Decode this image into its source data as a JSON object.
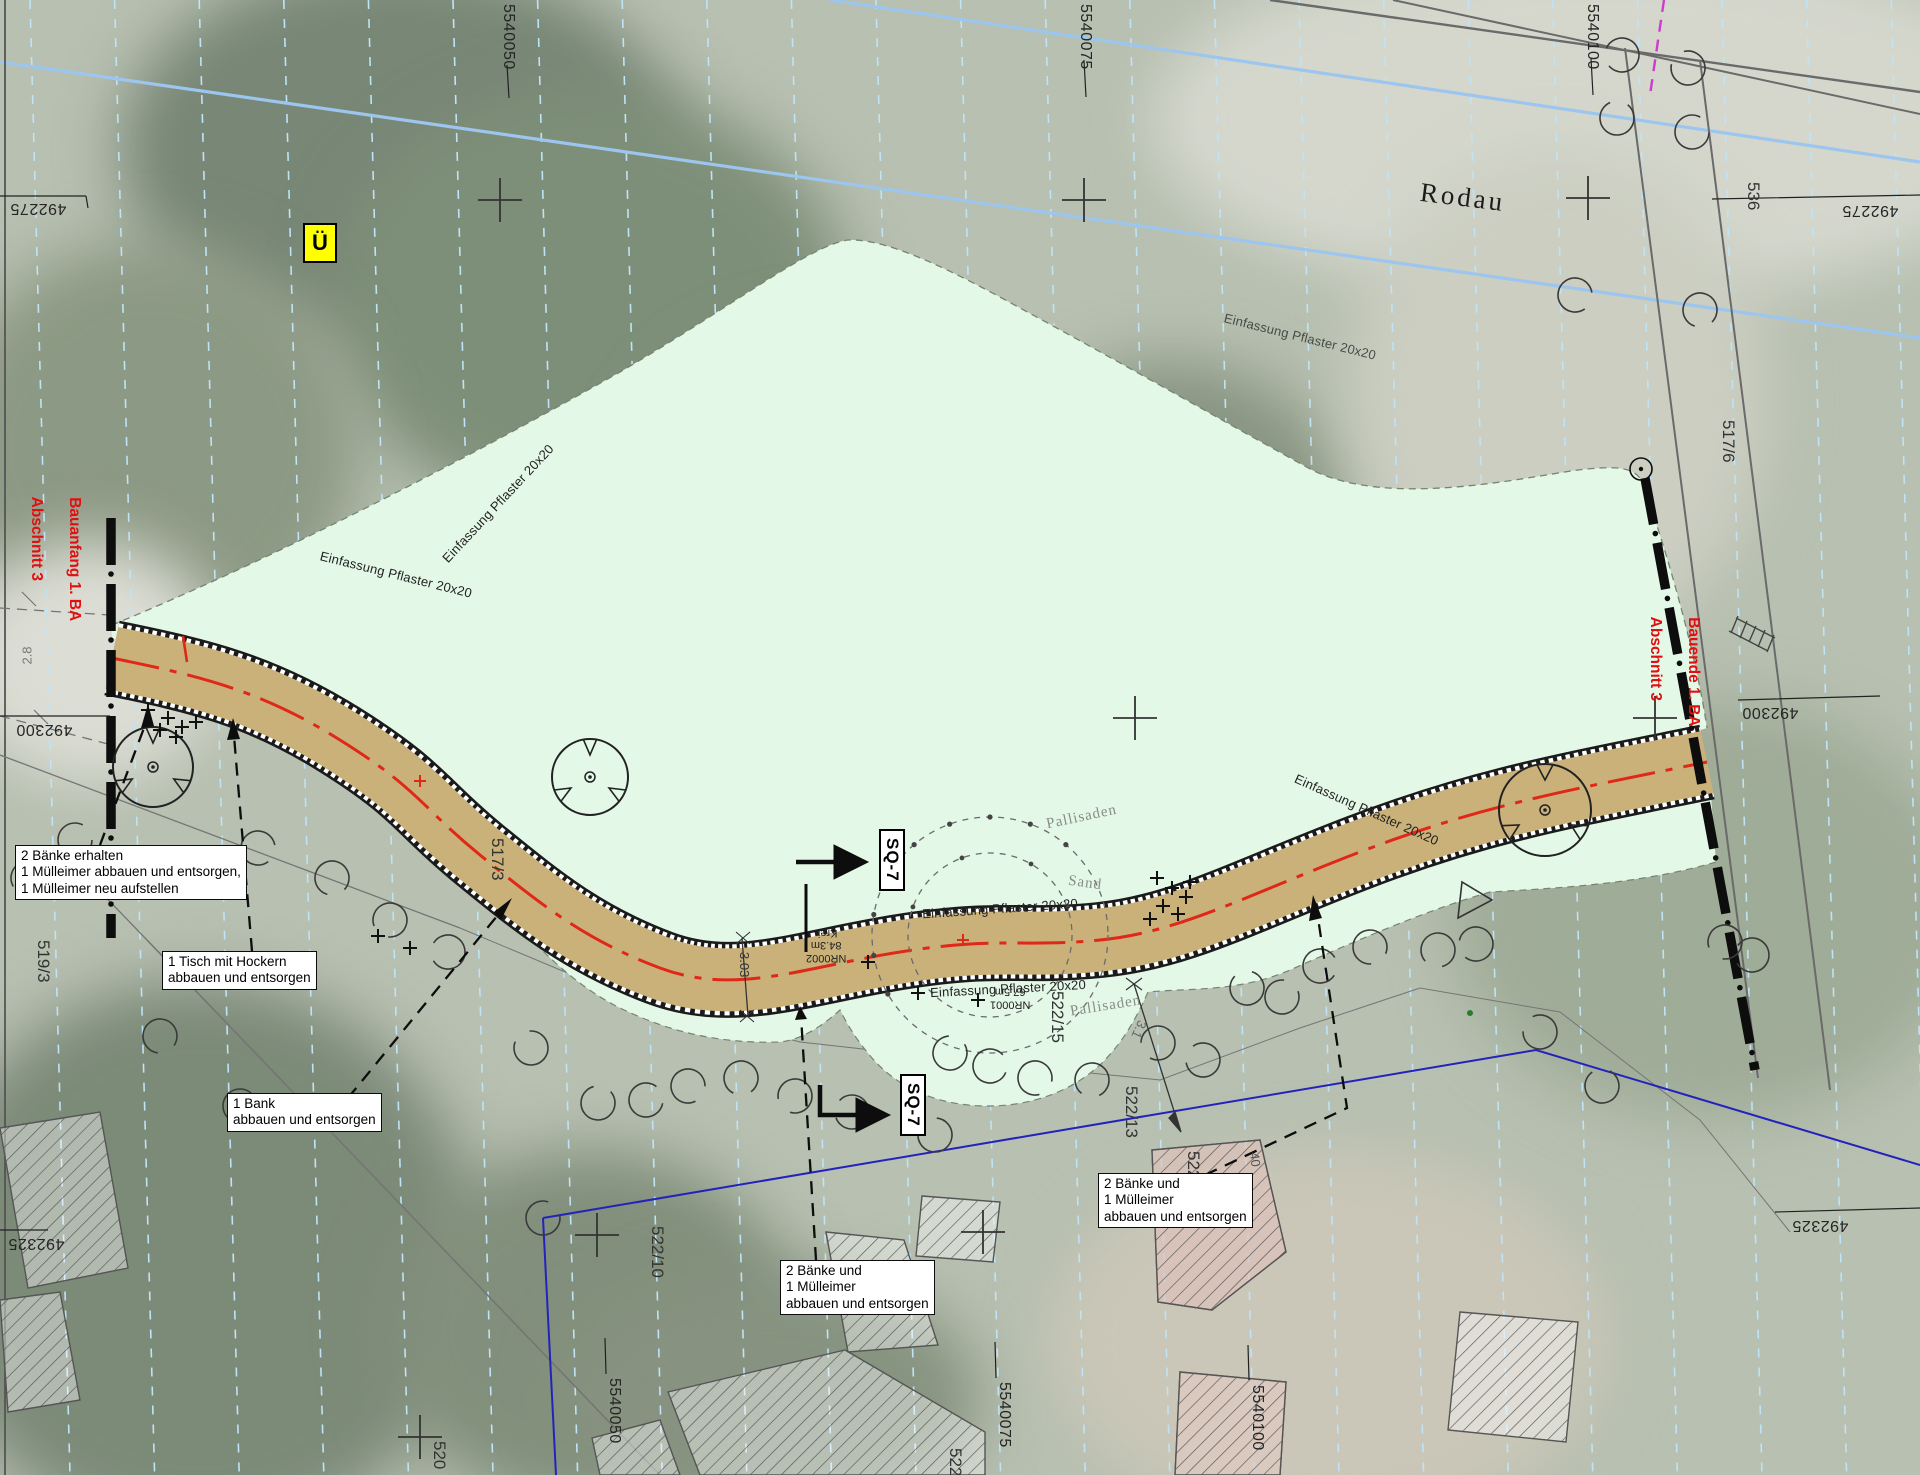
{
  "map": {
    "waterway_label": "Rodau",
    "ue_marker": "Ü",
    "sand_label": "Sand",
    "pallisaden_label": "Pallisaden",
    "edging_label": "Einfassung Pflaster 20x20",
    "section_label": "SQ-7",
    "construction_markers": {
      "start": [
        "Bauanfang 1. BA",
        "Abschnitt 3"
      ],
      "end": [
        "Bauende 1. BA",
        "Abschnitt 3"
      ]
    }
  },
  "grid": {
    "top": [
      "5540050",
      "5540075",
      "5540100"
    ],
    "bottom": [
      "5540050",
      "5540075",
      "5540100"
    ],
    "left": [
      "492275",
      "492300",
      "492325"
    ],
    "right": [
      "492275",
      "492300",
      "492325"
    ]
  },
  "parcels": {
    "p519_3": "519/3",
    "p517_3": "517/3",
    "p517_6": "517/6",
    "p536": "536",
    "p520": "520",
    "p522_10": "522/10",
    "p522_13": "522/13",
    "p522_15": "522/15",
    "p522_16": "522/16",
    "p522_cut": "522"
  },
  "segments": {
    "nr0002": "NR0002",
    "len0002": "84.3m",
    "krei": "Krei.",
    "nr0001": "NR0001",
    "len0001": "67.5m"
  },
  "dimensions": {
    "w_28": "2.8",
    "w_303": "3.03",
    "w_31": "3.1",
    "b_40": "40"
  },
  "annotations": {
    "keep_benches": "2 Bänke erhalten\n1 Mülleimer abbauen und entsorgen,\n1 Mülleimer neu aufstellen",
    "table": "1 Tisch mit Hockern\nabbauen und entsorgen",
    "bench": "1 Bank\nabbauen und entsorgen",
    "two_benches_a": "2 Bänke und\n1 Mülleimer\nabbauen und entsorgen",
    "two_benches_b": "2 Bänke und\n1 Mülleimer\nabbauen und entsorgen"
  },
  "colors": {
    "path_fill": "#c9b179",
    "green_area": "#e4f8e7",
    "centerline_red": "#e02818",
    "marker_red": "#e01010",
    "water_blue": "#9cc6ee",
    "grid_cyan": "#bfe3f7",
    "boundary_blue": "#2323bb",
    "highlight_yellow": "#ffff00"
  }
}
